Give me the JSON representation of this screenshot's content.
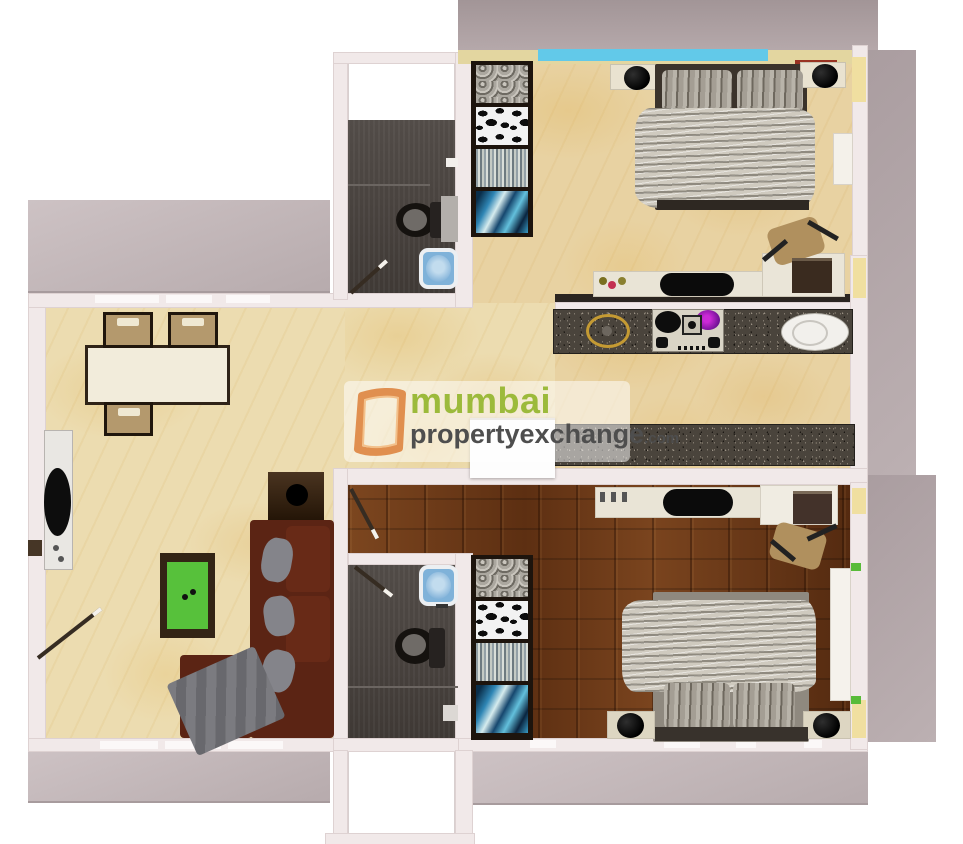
{
  "watermark": {
    "city": "mumbai",
    "name": "propertyexchange",
    "tld": ".com"
  },
  "colors": {
    "background": "#ffffff",
    "outdoor_terrace": "#b2a5a7",
    "wall": "#f1e9e9",
    "marble_floor": "#ecdcb0",
    "wood_floor": "#6b3a1b",
    "bathroom_floor": "#49433f",
    "granite_counter": "#4a443c",
    "sofa_brown": "#5b2414",
    "coffee_table_green": "#57c13b",
    "window_blue": "#62c9e9",
    "basin_blue": "#7fb2d9",
    "accent_yellow": "#f0dfa0",
    "brand_green": "#9cba3b",
    "brand_orange": "#e08f4f",
    "brand_gray": "#4e4e4e"
  }
}
